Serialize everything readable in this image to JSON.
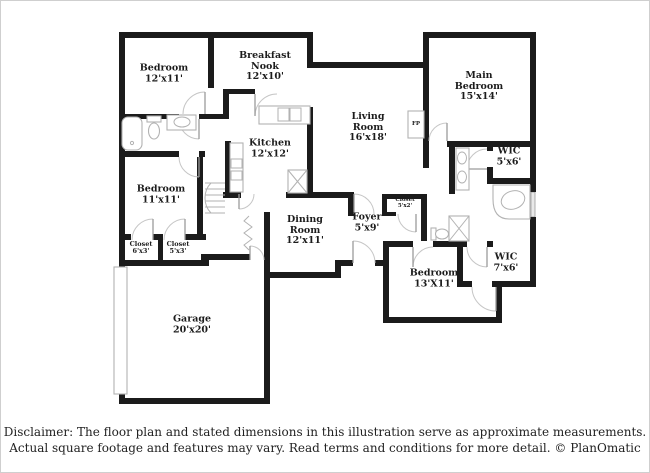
{
  "rooms": {
    "bedroom_top_left": {
      "name": "Bedroom",
      "dims": "12'x11'"
    },
    "breakfast_nook": {
      "name": "Breakfast Nook",
      "dims": "12'x10'"
    },
    "main_bedroom": {
      "name": "Main Bedroom",
      "dims": "15'x14'"
    },
    "living_room": {
      "name": "Living Room",
      "dims": "16'x18'"
    },
    "kitchen": {
      "name": "Kitchen",
      "dims": "12'x12'"
    },
    "wic_main": {
      "name": "WIC",
      "dims": "5'x6'"
    },
    "bedroom_left": {
      "name": "Bedroom",
      "dims": "11'x11'"
    },
    "closet_left_1": {
      "name": "Closet",
      "dims": "6'x3'"
    },
    "closet_left_2": {
      "name": "Closet",
      "dims": "5'x3'"
    },
    "dining_room": {
      "name": "Dining Room",
      "dims": "12'x11'"
    },
    "foyer": {
      "name": "Foyer",
      "dims": "5'x9'"
    },
    "closet_foyer": {
      "name": "Closet",
      "dims": "5'x2'"
    },
    "bedroom_bottom": {
      "name": "Bedroom",
      "dims": "13'X11'"
    },
    "wic_bottom": {
      "name": "WIC",
      "dims": "7'x6'"
    },
    "garage": {
      "name": "Garage",
      "dims": "20'x20'"
    },
    "fireplace": {
      "abbr": "FP"
    }
  },
  "disclaimer": {
    "line1": "Disclaimer: The floor plan and stated dimensions in this illustration serve as approximate measurements.",
    "line2": "Actual square footage and features may vary. Read terms and conditions for more detail. © PlanOmatic"
  },
  "colors": {
    "wall": "#1b1b1b",
    "window_fill": "#e9e9e9",
    "fixture_outline": "#b2b2b2",
    "text": "#1c1c1c",
    "background": "#ffffff",
    "border": "#cfcfcf"
  }
}
